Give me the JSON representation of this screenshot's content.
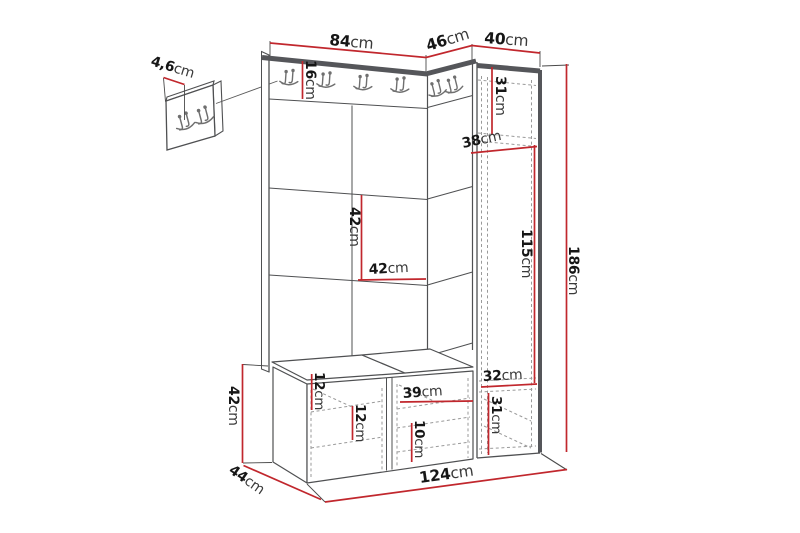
{
  "diagram": {
    "type": "furniture-dimension-drawing",
    "subject": "hallway set with coat-hook wall panel, wardrobe cabinet and shoe bench"
  },
  "labels": {
    "hook_panel_depth": "4,6cm",
    "panel_width": "84cm",
    "corner_panel_width": "46cm",
    "wardrobe_width": "40cm",
    "hook_rail_height": "16cm",
    "wardrobe_top_compartment_height": "31cm",
    "wardrobe_shelf_depth": "38cm",
    "panel_tile_height": "42cm",
    "panel_tile_width": "42cm",
    "wardrobe_door_height": "115cm",
    "total_height": "186cm",
    "bench_top_to_shelf": "12cm",
    "bench_shelf_spacing": "12cm",
    "bench_compartment_width": "39cm",
    "bench_lower_shelf_spacing": "10cm",
    "wardrobe_lower_compartment_width": "32cm",
    "wardrobe_lower_compartment_height": "31cm",
    "bench_height": "42cm",
    "bench_depth": "44cm",
    "total_width": "124cm"
  },
  "colors": {
    "dimension_red": "#c1272d",
    "frame_dark": "#55565a",
    "outline": "#4f5052",
    "hidden_line": "#9a9a9a"
  }
}
